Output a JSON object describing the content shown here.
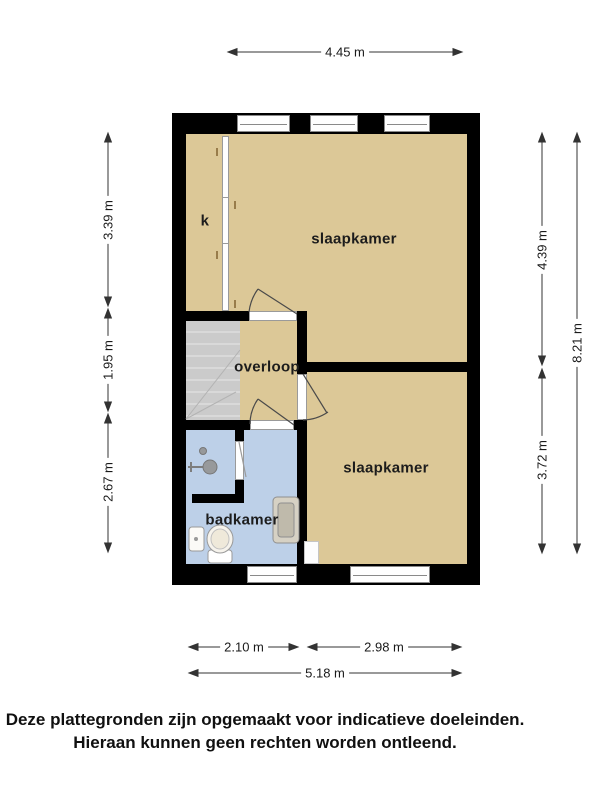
{
  "title": "floor plan (plattegrond) - upper storey",
  "rooms": {
    "bedroom_top": "slaapkamer",
    "bedroom_bottom": "slaapkamer",
    "landing": "overloop",
    "bathroom": "badkamer",
    "closet": "k"
  },
  "dimensions": {
    "top": "4.45 m",
    "left": [
      "3.39 m",
      "1.95 m",
      "2.67 m"
    ],
    "right": [
      "4.39 m",
      "3.72 m"
    ],
    "right_total": "8.21 m",
    "bottom": [
      "2.10 m",
      "2.98 m"
    ],
    "bottom_total": "5.18 m"
  },
  "disclaimer": {
    "line1": "Deze plattegronden zijn opgemaakt voor indicatieve doeleinden.",
    "line2": "Hieraan kunnen geen rechten worden ontleend."
  },
  "colors": {
    "floor": "#dcc897",
    "bath": "#bdd0e8",
    "stairs": "#cbcbcb",
    "wall": "#000000"
  }
}
